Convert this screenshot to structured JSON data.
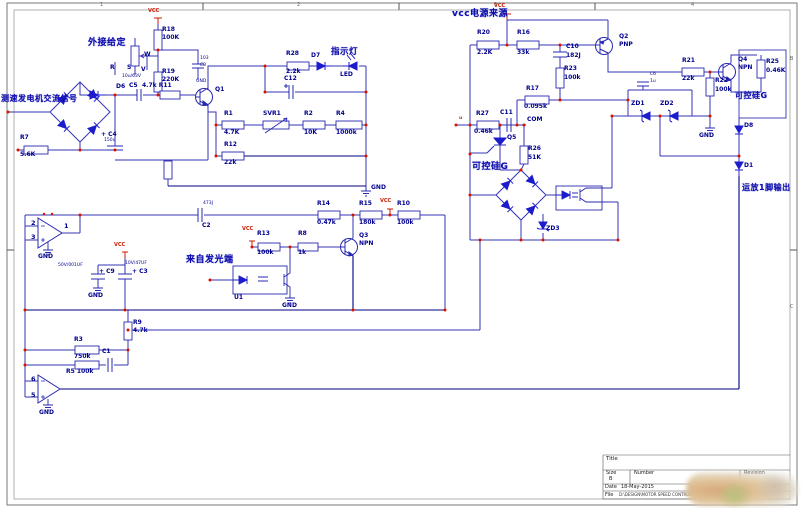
{
  "t": {
    "tacho": "测速发电机交流信号",
    "ext": "外接给定",
    "lamp": "指示灯",
    "vcc_src": "vcc电源来源",
    "from_opto": "来自发光端",
    "scr_l": "可控硅G",
    "scr_r": "可控硅G",
    "out": "运放1脚输出",
    "com": "COM",
    "u": "u"
  },
  "p": {
    "vcc": "VCC",
    "gnd": "GND"
  },
  "pins": {
    "op1m": "2",
    "op1p": "3",
    "op1o": "1",
    "op2m": "6",
    "op2p": "5"
  },
  "c": {
    "r18": {
      "r": "R18",
      "v": "100K"
    },
    "r19": {
      "r": "R19",
      "v": "220K"
    },
    "c8": {
      "r": "C8",
      "v": "103"
    },
    "pot": {
      "pw": "W",
      "pr": "R",
      "ps": "S",
      "pv": "V"
    },
    "d6": {
      "r": "D6"
    },
    "c5": {
      "r": "C5",
      "v": "10u/63V"
    },
    "r11": {
      "r": "4.7k R11"
    },
    "c4": {
      "r": "+ C4",
      "v": "150u"
    },
    "r7": {
      "r": "R7",
      "v": "5.6K"
    },
    "q1": {
      "r": "Q1"
    },
    "r1": {
      "r": "R1",
      "v": "4.7K"
    },
    "svr1": {
      "r": "SVR1"
    },
    "r2": {
      "r": "R2",
      "v": "10K"
    },
    "r4": {
      "r": "R4",
      "v": "1000k"
    },
    "r12": {
      "r": "R12",
      "v": "22k"
    },
    "r28": {
      "r": "R28",
      "v": "2.2k"
    },
    "d7": {
      "r": "D7"
    },
    "led": {
      "r": "LED"
    },
    "c12": {
      "r": "C12"
    },
    "c2": {
      "r": "C2",
      "v": "473J"
    },
    "c9": {
      "r": "+ C9",
      "v": "50V/001UF"
    },
    "c3": {
      "r": "+ C3",
      "v": "10V/47UF"
    },
    "r13": {
      "r": "R13",
      "v": "100k"
    },
    "r8": {
      "r": "R8",
      "v": "1k"
    },
    "q3": {
      "r": "Q3",
      "t": "NPN"
    },
    "r14": {
      "r": "R14",
      "v": "0.47k"
    },
    "r15": {
      "r": "R15",
      "v": "180k"
    },
    "r10": {
      "r": "R10",
      "v": "100k"
    },
    "u1": {
      "r": "U1"
    },
    "r9": {
      "r": "R9",
      "v": "4.7k"
    },
    "r3": {
      "r": "R3",
      "v": "750k"
    },
    "c1": {
      "r": "C1"
    },
    "r5": {
      "r": "R5 100k"
    },
    "r20": {
      "r": "R20",
      "v": "2.2K"
    },
    "r16": {
      "r": "R16",
      "v": "33k"
    },
    "c10": {
      "r": "C10",
      "v": "182J"
    },
    "r23": {
      "r": "R23",
      "v": "100k"
    },
    "r17": {
      "r": "R17",
      "v": "0.095k"
    },
    "q2": {
      "r": "Q2",
      "t": "PNP"
    },
    "r27": {
      "r": "R27",
      "v": "0.46k"
    },
    "c11": {
      "r": "C11"
    },
    "q5": {
      "r": "Q5"
    },
    "r26": {
      "r": "R26",
      "v": "51K"
    },
    "zd3": {
      "r": "ZD3"
    },
    "c6": {
      "r": "C6",
      "v": "1u"
    },
    "zd1": {
      "r": "ZD1"
    },
    "zd2": {
      "r": "ZD2"
    },
    "r21": {
      "r": "R21",
      "v": "22k"
    },
    "r22": {
      "r": "R22",
      "v": "100k"
    },
    "q4": {
      "r": "Q4",
      "t": "NPN"
    },
    "r25": {
      "r": "R25",
      "v": "0.46K"
    },
    "d8": {
      "r": "D8"
    },
    "d1": {
      "r": "D1"
    }
  },
  "zones": {
    "t1": "1",
    "t2": "2",
    "t3": "3",
    "t4": "4",
    "r1": "B",
    "r2": "C"
  },
  "tb": {
    "title": "Title",
    "size_l": "Size",
    "size": "B",
    "number_l": "Number",
    "rev_l": "Revision",
    "date_l": "Date",
    "date": "18-May-2015",
    "sheet_l": "Sheet",
    "of": "of",
    "file_l": "File",
    "file": "D:\\DESIGN\\MOTOR SPEED CONTROL.SCH",
    "drawn_l": "Drawn By"
  }
}
